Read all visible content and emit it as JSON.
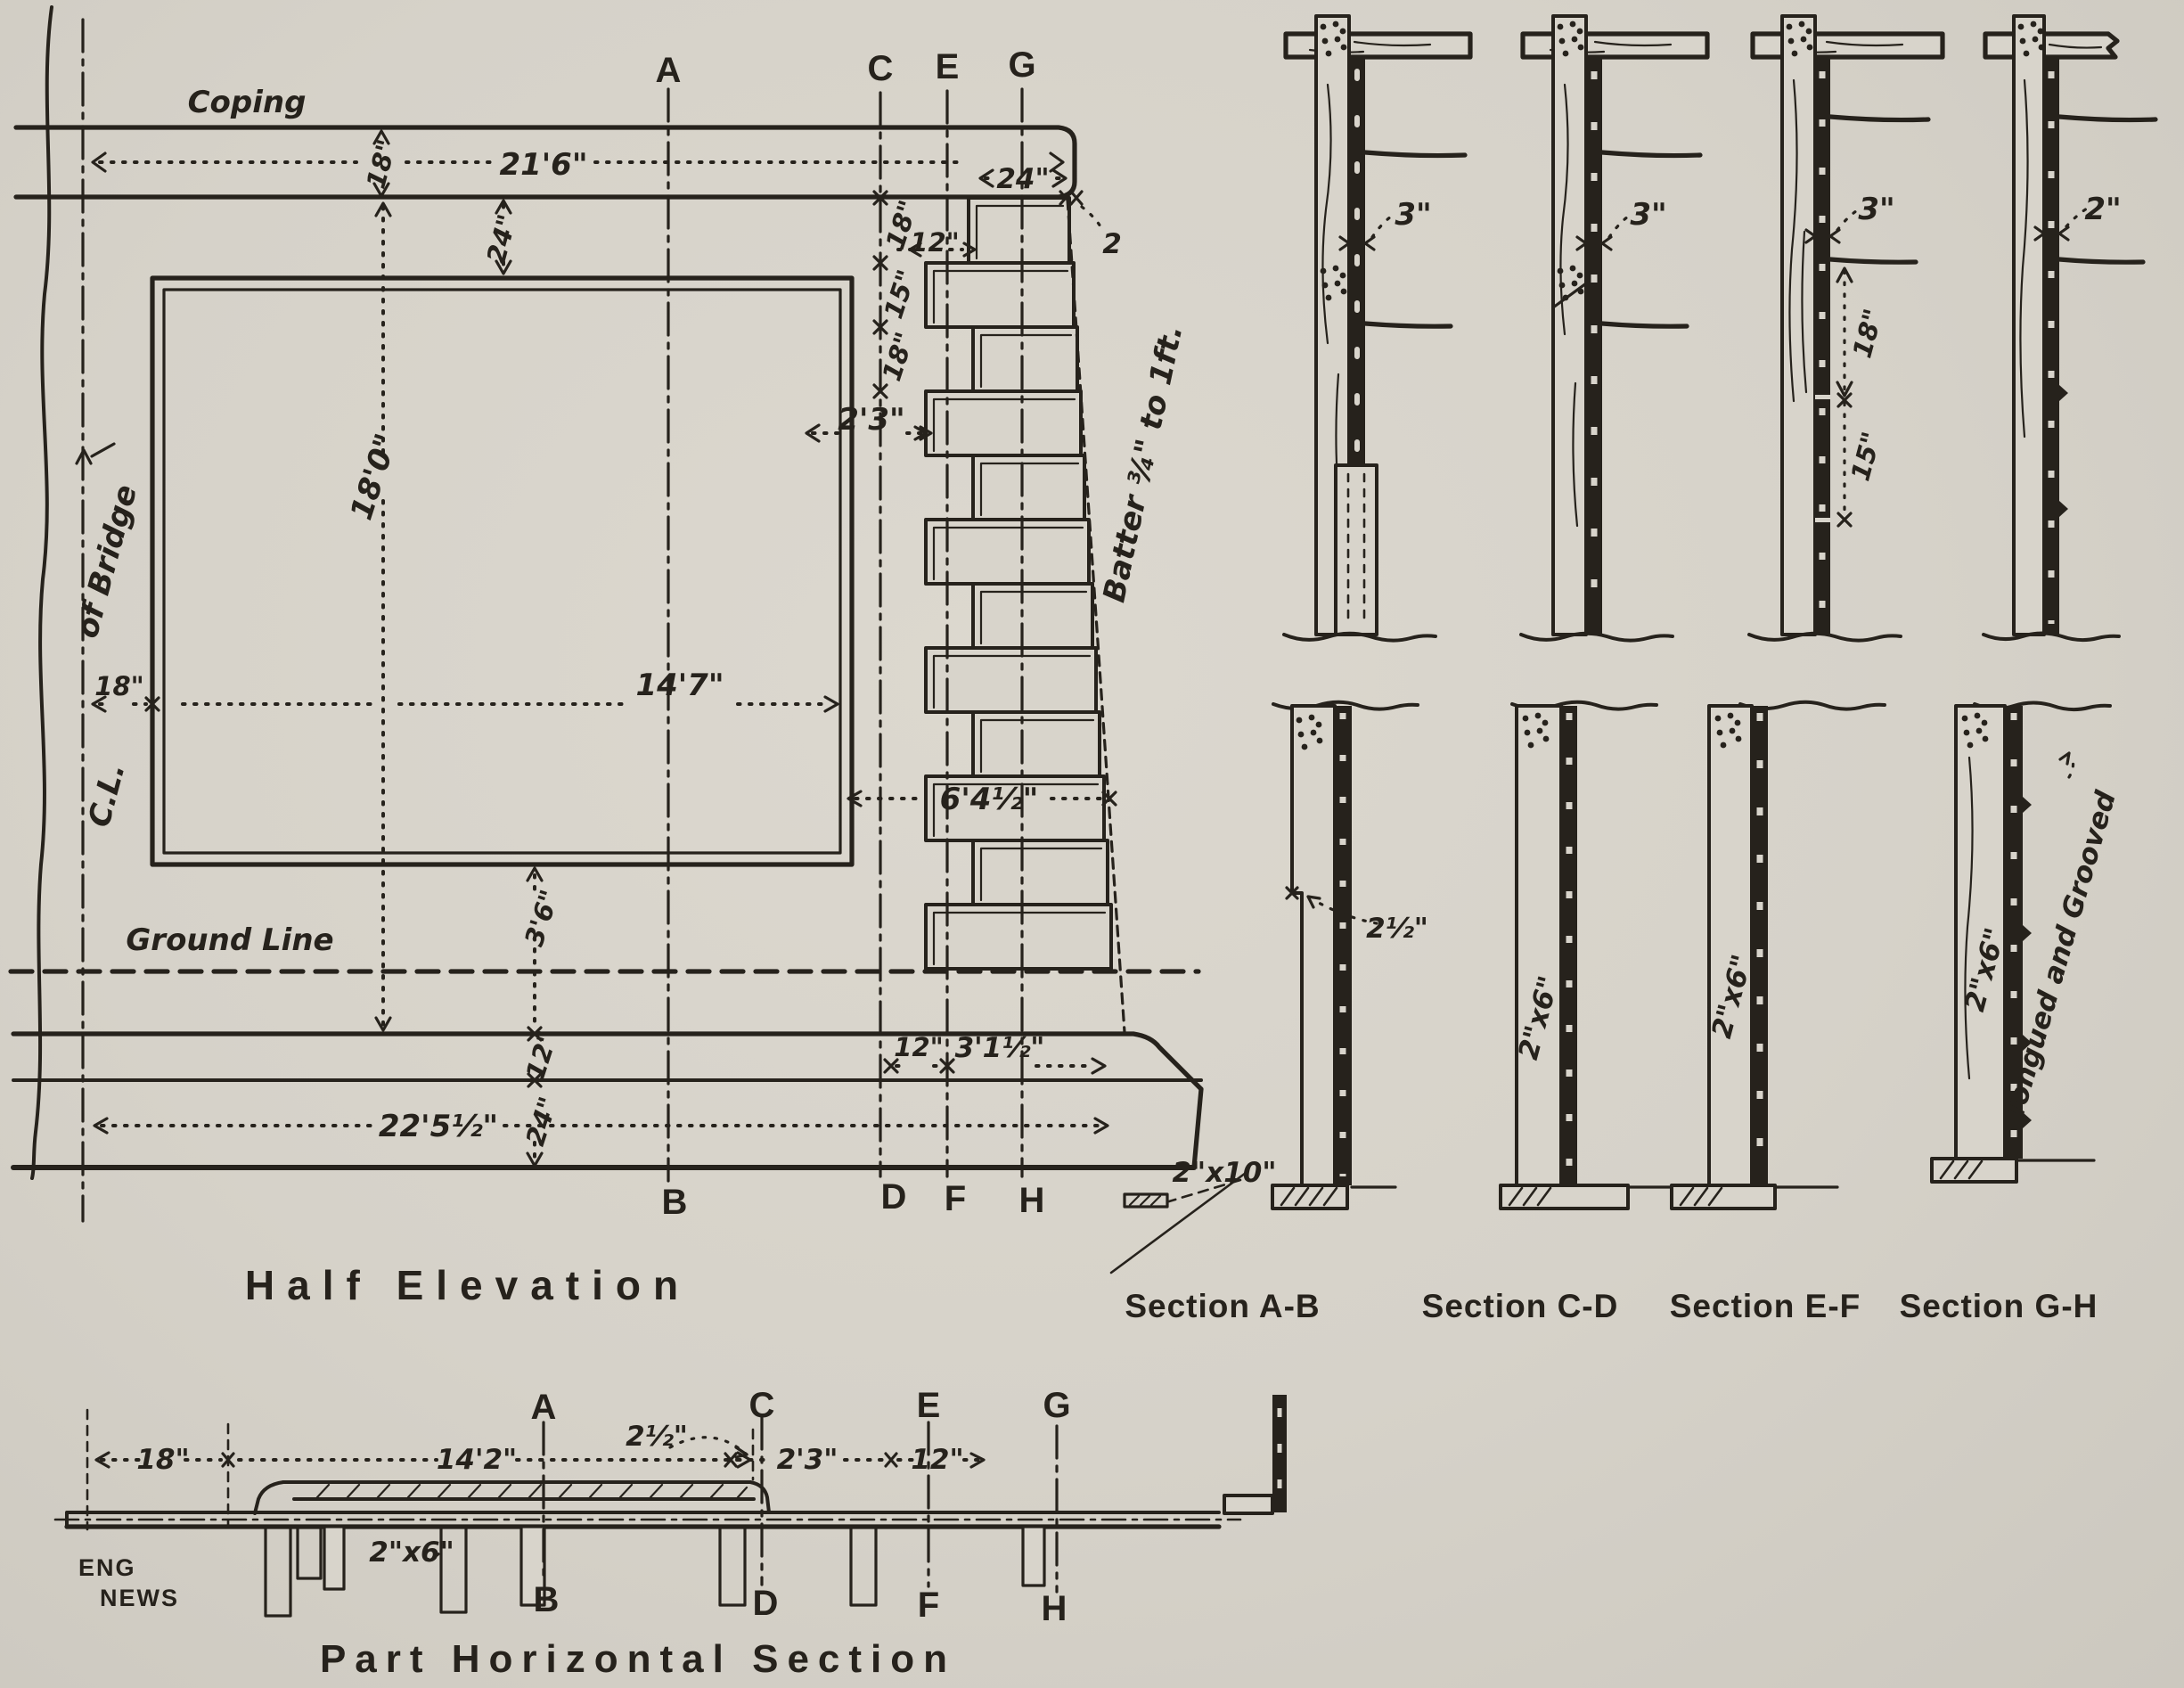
{
  "colors": {
    "paper": "#d8d4cb",
    "ink": "#26221c"
  },
  "titles": {
    "elevation": "Half Elevation",
    "plan": "Part Horizontal Section",
    "section_ab": "Section A-B",
    "section_cd": "Section C-D",
    "section_ef": "Section E-F",
    "section_gh": "Section G-H",
    "credit_line1": "ENG",
    "credit_line2": "NEWS"
  },
  "letters": {
    "a": "A",
    "b": "B",
    "c": "C",
    "d": "D",
    "e": "E",
    "f": "F",
    "g": "G",
    "h": "H"
  },
  "elevation_labels": {
    "coping": "Coping",
    "center_line": "C.L.",
    "of_bridge": "of Bridge",
    "ground_line": "Ground Line",
    "batter": "Batter ¾\" to 1ft.",
    "plank_sill": "2\"x10\"",
    "dim_coping_length": "21'6\"",
    "dim_coping_height": "18\"",
    "dim_coping_to_panel": "24\"",
    "dim_coping_end": "24\"",
    "dim_top_inset": "2",
    "dim_board_offset": "12\"",
    "dim_board_18a": "18\"",
    "dim_board_15": "15\"",
    "dim_board_18b": "18\"",
    "dim_2_3": "2'3\"",
    "dim_wall_height": "18'0\"",
    "dim_cl_offset": "18\"",
    "dim_panel_width": "14'7\"",
    "dim_mid_width": "6'4½\"",
    "dim_3_6": "3'6\"",
    "dim_foot_12": "12\"",
    "dim_foot_24": "24\"",
    "dim_base_12": "12\"",
    "dim_base_3_1": "3'1½\"",
    "dim_base_width": "22'5½\""
  },
  "section_labels": {
    "ab_3": "3\"",
    "cd_3": "3\"",
    "ef_3": "3\"",
    "gh_2": "2\"",
    "ef_18": "18\"",
    "ef_15": "15\"",
    "ab_2_5": "2½\"",
    "cd_2x6": "2\"x6\"",
    "ef_2x6": "2\"x6\"",
    "gh_2x6": "2\"x6\"",
    "gh_tongued": "Tongued and Grooved"
  },
  "plan_labels": {
    "dim_18": "18\"",
    "dim_14_2": "14'2\"",
    "dim_2_5": "2½\"",
    "dim_2_3": "2'3\"",
    "dim_12": "12\"",
    "stud": "2\"x6\""
  }
}
